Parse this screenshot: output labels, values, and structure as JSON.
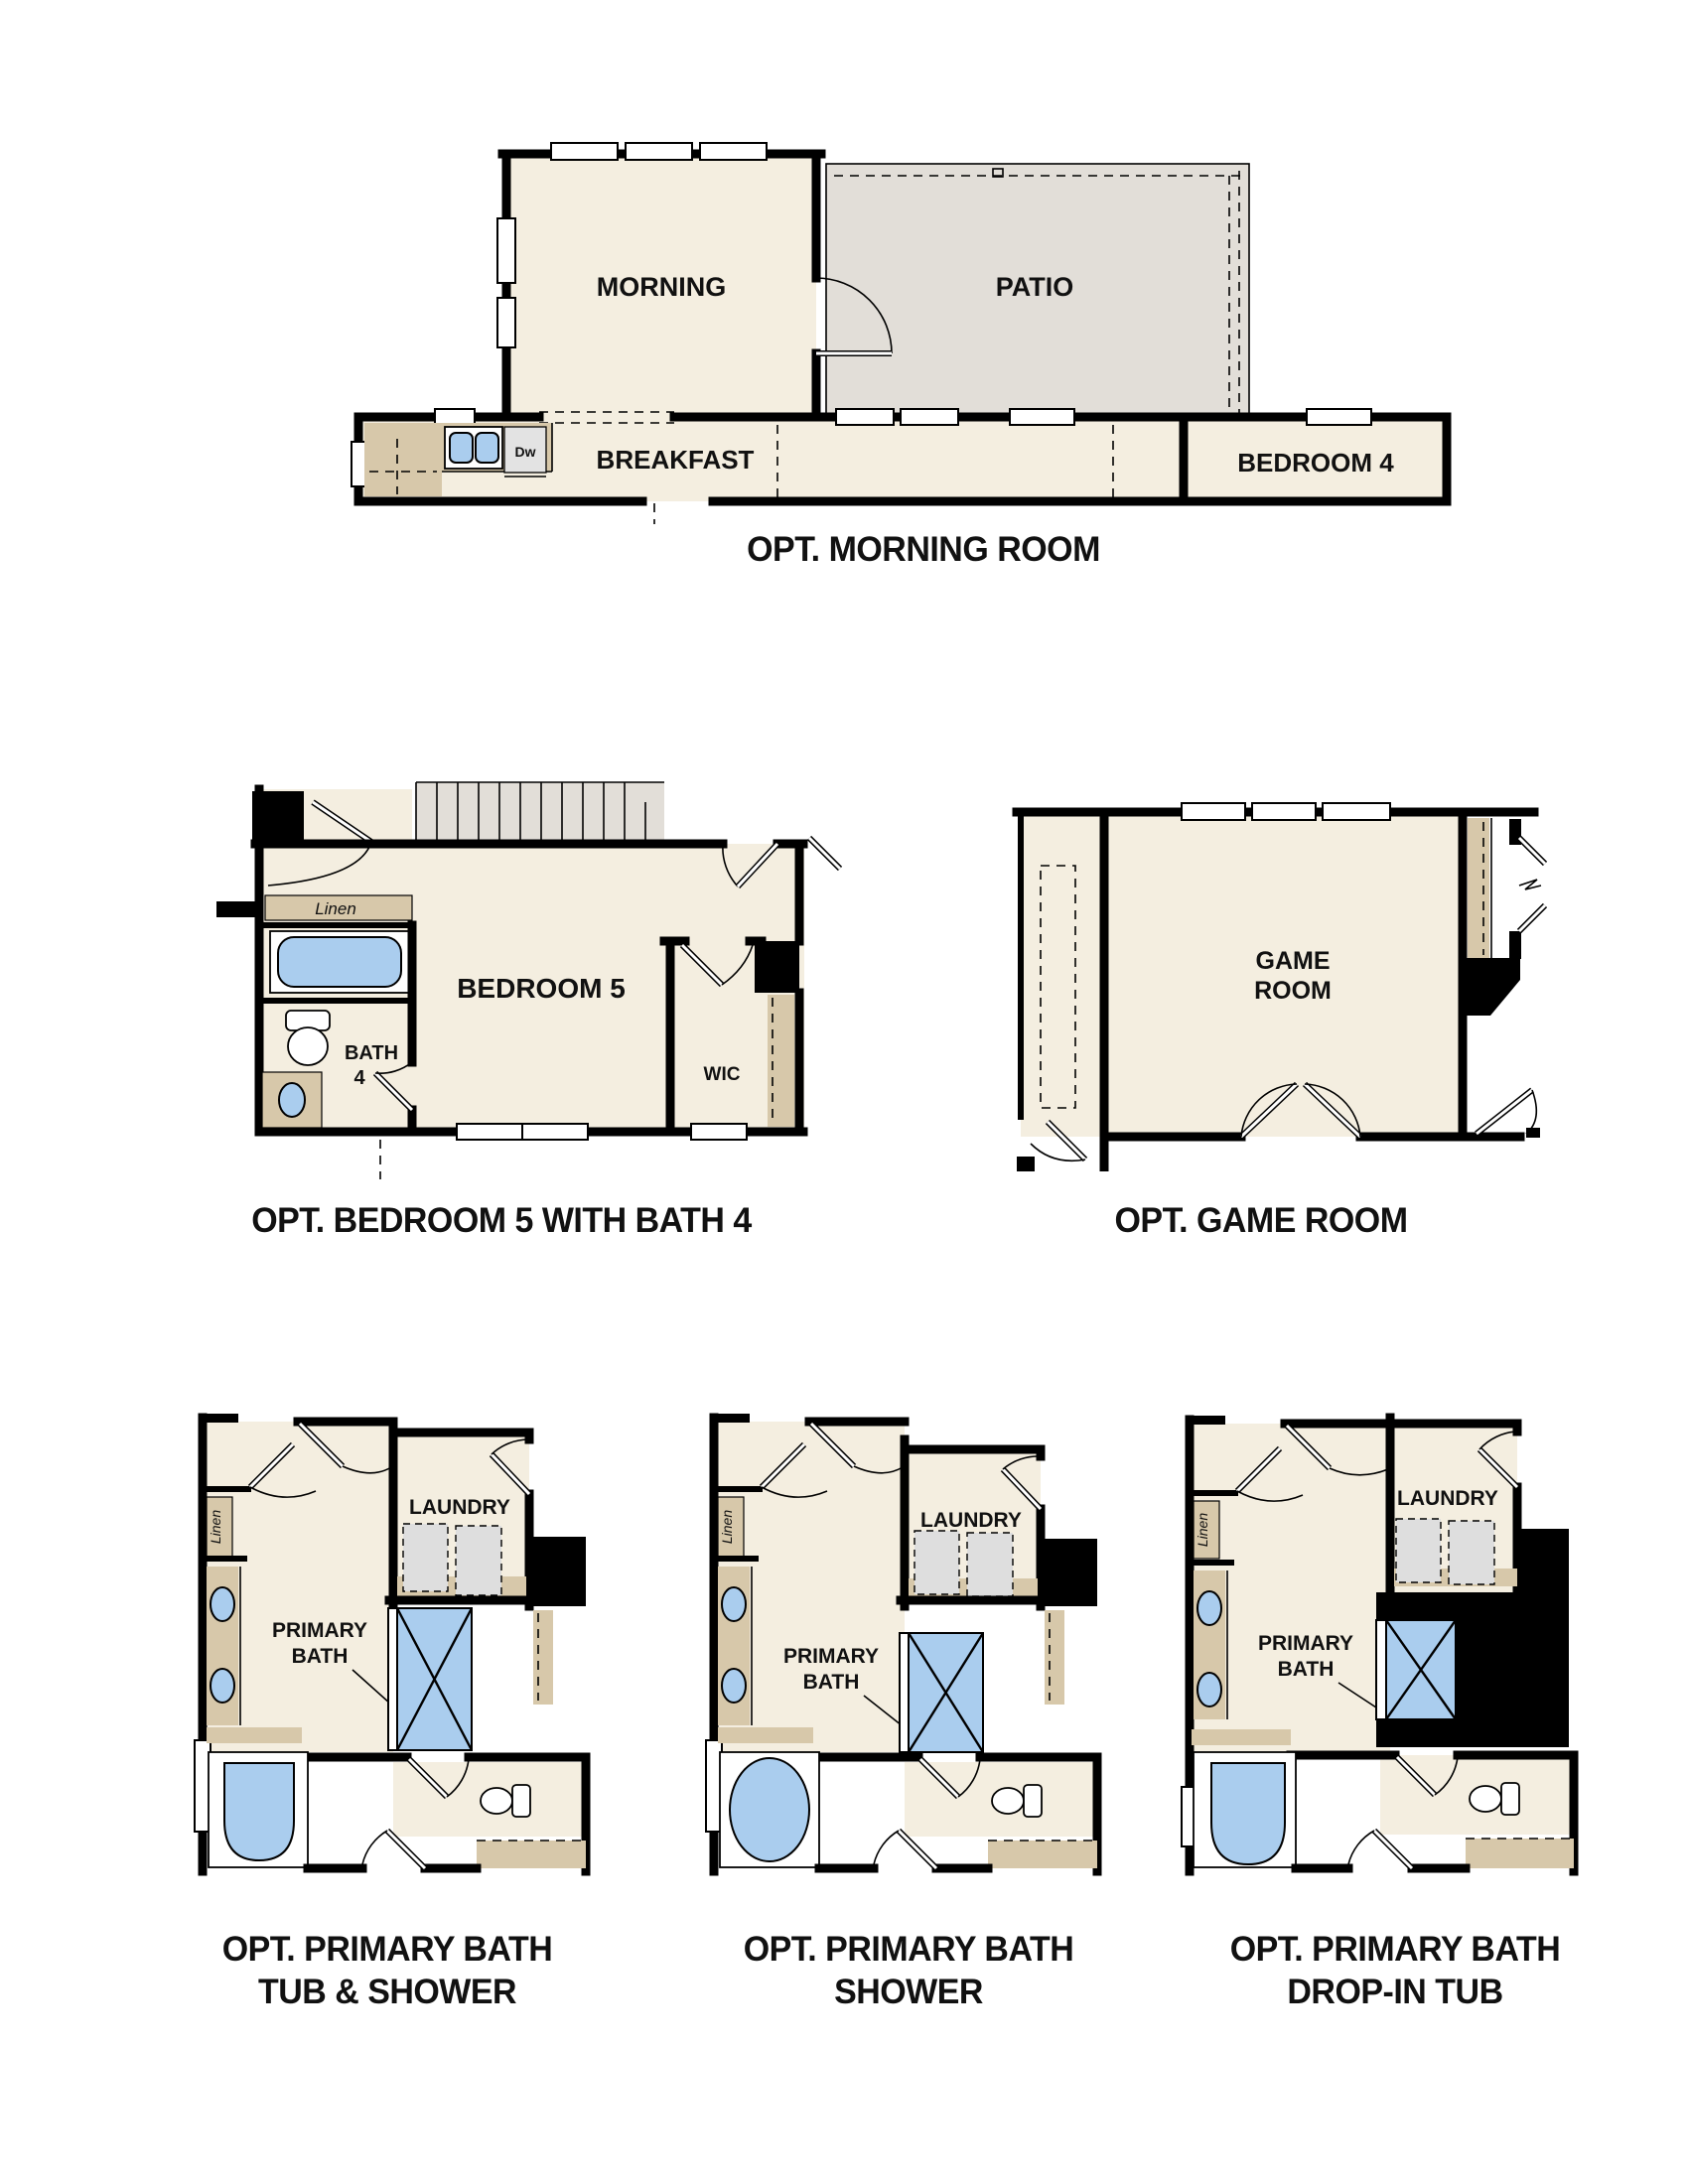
{
  "document": {
    "background": "#ffffff"
  },
  "colors": {
    "room_fill": "#f4eee0",
    "patio_fill": "#e2ded8",
    "counter_tan": "#d7c8aa",
    "fixture_blue": "#aacdee",
    "appliance_gray": "#dedede",
    "wall_black": "#000000"
  },
  "figures": {
    "morning_room": {
      "caption": "OPT. MORNING ROOM",
      "labels": {
        "morning": "MORNING",
        "patio": "PATIO",
        "breakfast": "BREAKFAST",
        "bedroom4": "BEDROOM 4",
        "dishwasher": "Dw"
      }
    },
    "bedroom5": {
      "caption": "OPT. BEDROOM 5 WITH BATH 4",
      "labels": {
        "bedroom5": "BEDROOM 5",
        "bath": "BATH",
        "bath_number": "4",
        "wic": "WIC",
        "linen": "Linen"
      }
    },
    "game_room": {
      "caption": "OPT. GAME ROOM",
      "labels": {
        "game": "GAME",
        "room": "ROOM"
      }
    },
    "primary_bath_tub_shower": {
      "caption_line1": "OPT. PRIMARY BATH",
      "caption_line2": "TUB & SHOWER",
      "labels": {
        "primary": "PRIMARY",
        "bath": "BATH",
        "laundry": "LAUNDRY",
        "linen": "Linen"
      }
    },
    "primary_bath_shower": {
      "caption_line1": "OPT. PRIMARY BATH",
      "caption_line2": "SHOWER",
      "labels": {
        "primary": "PRIMARY",
        "bath": "BATH",
        "laundry": "LAUNDRY",
        "linen": "Linen"
      }
    },
    "primary_bath_dropin": {
      "caption_line1": "OPT. PRIMARY BATH",
      "caption_line2": "DROP-IN TUB",
      "labels": {
        "primary": "PRIMARY",
        "bath": "BATH",
        "laundry": "LAUNDRY",
        "linen": "Linen"
      }
    }
  }
}
